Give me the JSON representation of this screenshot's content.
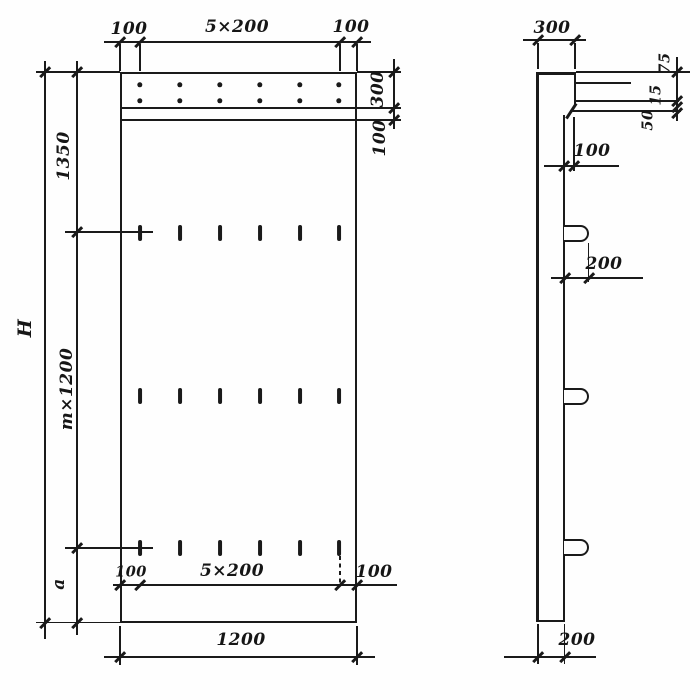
{
  "front_view": {
    "top_dimensions": {
      "left_margin": "100",
      "spacing": "5×200",
      "right_margin": "100"
    },
    "right_dimensions": {
      "top_band": "300",
      "strip": "100"
    },
    "left_dimensions": {
      "overall": "H",
      "top": "1350",
      "middle": "m×1200",
      "bottom": "a"
    },
    "inner_bottom_dimensions": {
      "left_margin": "100",
      "spacing": "5×200",
      "right_margin": "100"
    },
    "bottom_dimension": {
      "width": "1200"
    }
  },
  "side_view": {
    "top_dimension": {
      "depth": "300"
    },
    "right_dimensions": {
      "d1": "75",
      "d2": "15",
      "d3": "50"
    },
    "step_dimension": "100",
    "loop_offset_dimension": "200",
    "bottom_dimension": "200"
  },
  "features": {
    "rebar_dot_rows": 2,
    "rebar_dot_columns": 6,
    "loop_rows": 3,
    "loops_per_row": 6
  },
  "colors": {
    "ink": "#1a1a1a",
    "paper": "#fefefe"
  }
}
